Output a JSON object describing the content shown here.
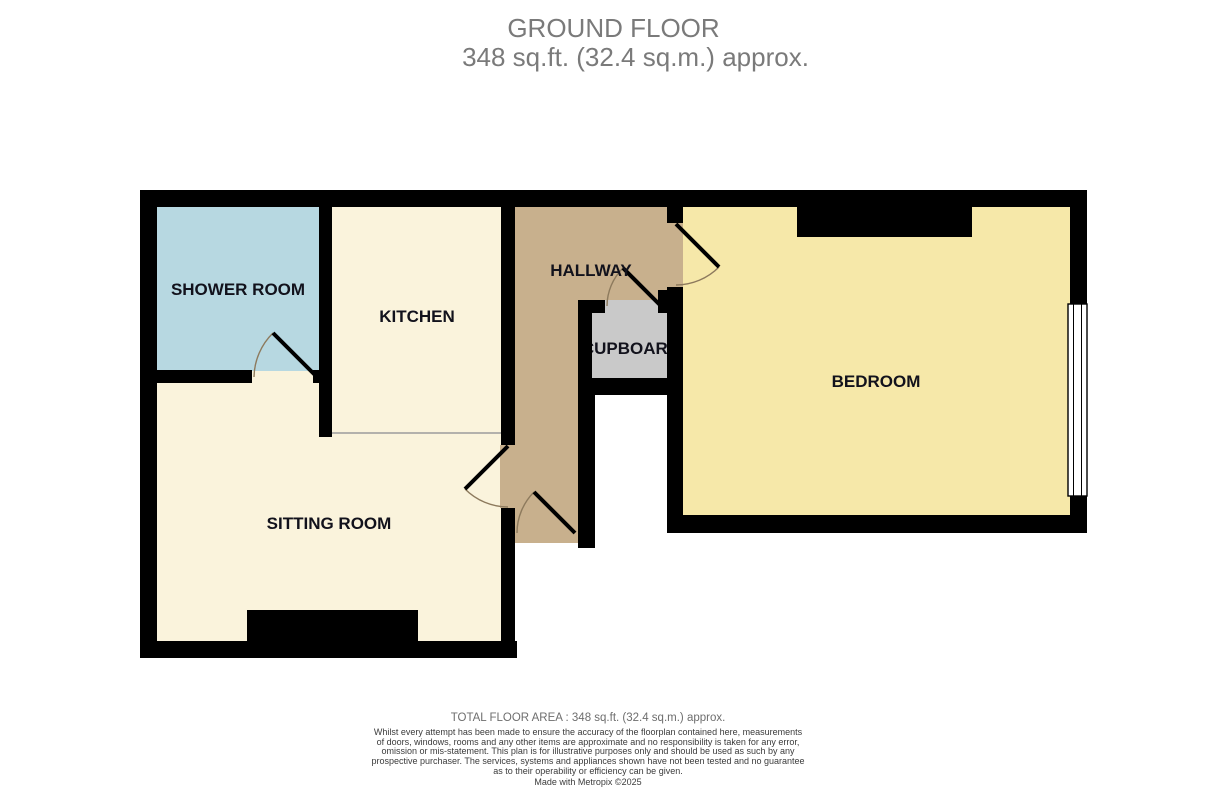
{
  "header": {
    "title": "GROUND FLOOR",
    "subtitle": "348 sq.ft. (32.4 sq.m.) approx."
  },
  "rooms": {
    "shower": {
      "label": "SHOWER ROOM",
      "color": "#b7d8e1"
    },
    "kitchen": {
      "label": "KITCHEN",
      "color": "#faf3dc"
    },
    "sitting": {
      "label": "SITTING ROOM",
      "color": "#faf3dc"
    },
    "hallway": {
      "label": "HALLWAY",
      "color": "#c8b08d"
    },
    "cupboard": {
      "label": "CUPBOARD",
      "color": "#c9c9c9"
    },
    "bedroom": {
      "label": "BEDROOM",
      "color": "#f6e8a9"
    }
  },
  "colors": {
    "wall": "#000000",
    "door_arc": "#8d7a5d",
    "divider_line": "#9b9b9b",
    "label_text": "#12121c",
    "window_fill": "#ffffff"
  },
  "footer": {
    "total_area": "TOTAL FLOOR AREA : 348 sq.ft. (32.4 sq.m.) approx.",
    "disclaimer_lines": [
      "Whilst every attempt has been made to ensure the accuracy of the floorplan contained here, measurements",
      "of doors, windows, rooms and any other items are approximate and no responsibility is taken for any error,",
      "omission or mis-statement. This plan is for illustrative purposes only and should be used as such by any",
      "prospective purchaser. The services, systems and appliances shown have not been tested and no guarantee",
      "as to their operability or efficiency can be given."
    ],
    "credit": "Made with Metropix ©2025"
  }
}
